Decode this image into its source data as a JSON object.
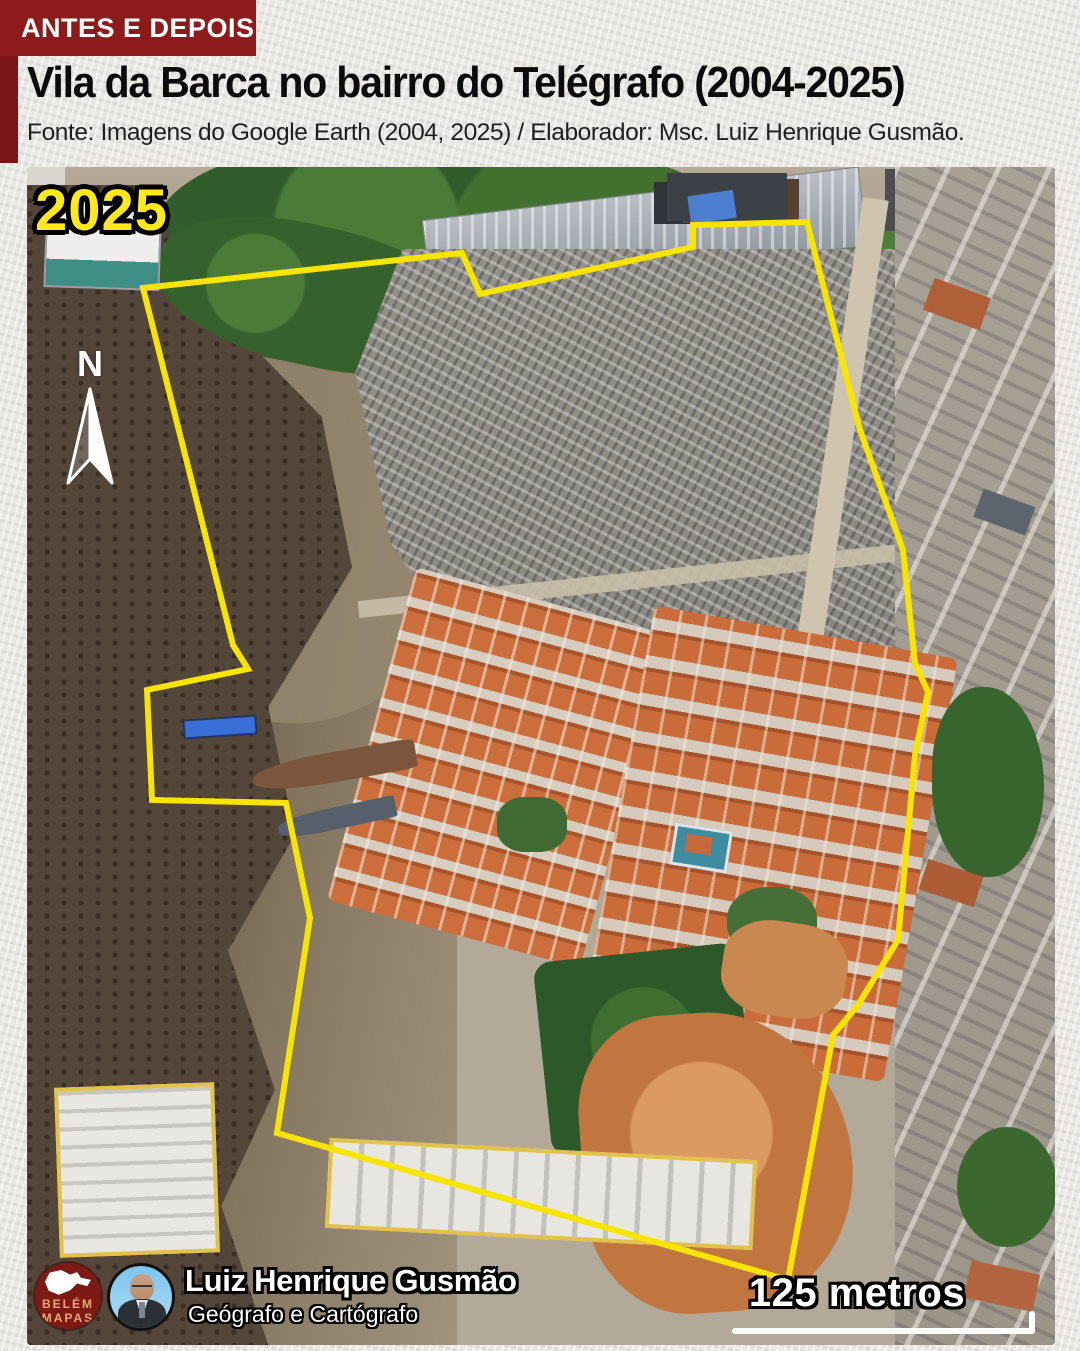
{
  "header": {
    "badge": "ANTES E DEPOIS",
    "title": "Vila da Barca no bairro do Telégrafo (2004-2025)",
    "source": "Fonte: Imagens do Google Earth (2004, 2025) / Elaborador: Msc. Luiz Henrique Gusmão."
  },
  "map": {
    "year_label": "2025",
    "north_label": "N",
    "scale_label": "125 metros"
  },
  "footer": {
    "logo_line1": "BELÉM",
    "logo_line2": "MAPAS",
    "author_name": "Luiz Henrique Gusmão",
    "author_role": "Geógrafo e Cartógrafo"
  },
  "colors": {
    "badge_red": "#8e1b1b",
    "ribbon_dark_red": "#7c1616",
    "boundary_yellow": "#f7e400",
    "year_yellow": "#ffe81e",
    "logo_red": "#7d1a14",
    "logo_text_salmon": "#eba57d"
  }
}
